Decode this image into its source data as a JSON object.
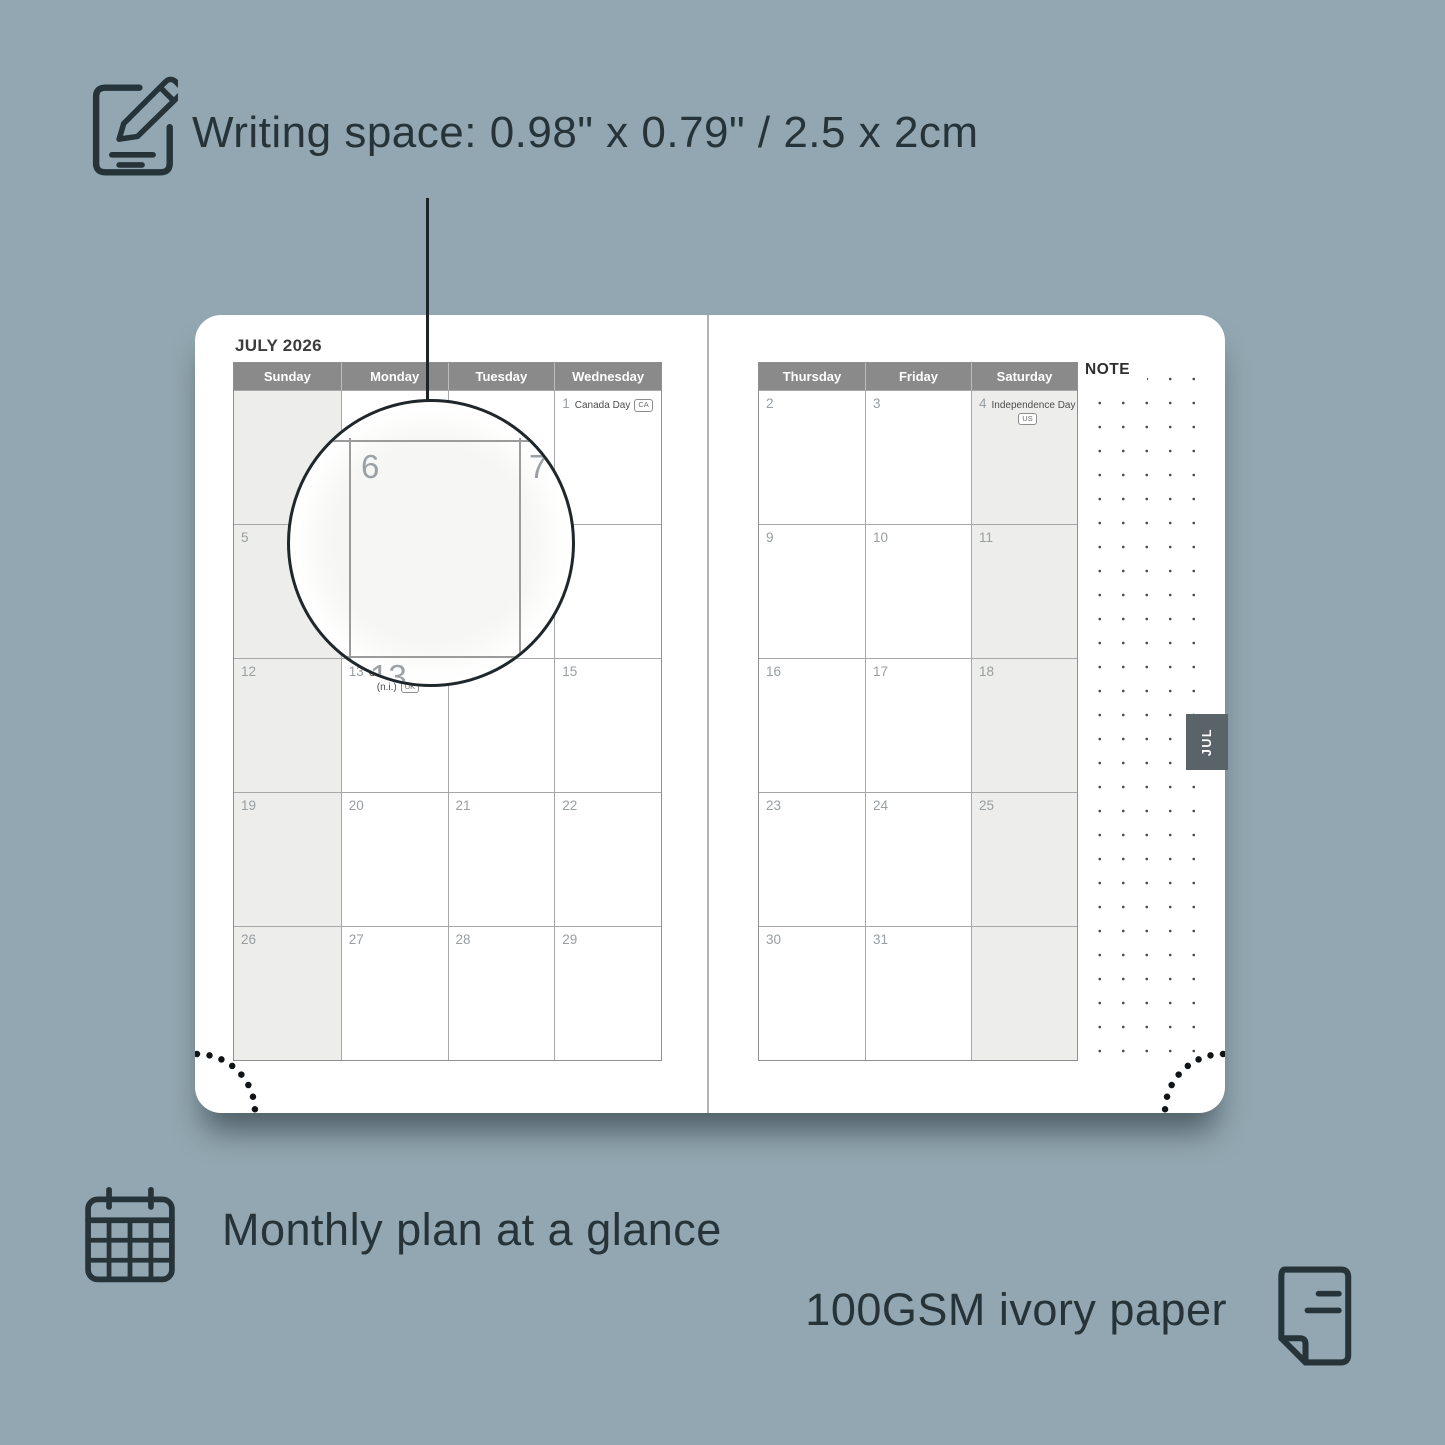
{
  "colors": {
    "background": "#92a7b1",
    "annotation_text": "#26343a",
    "header_bar": "#8a8a8a",
    "shaded_cell": "#ededeb",
    "tab": "#5a6468"
  },
  "features": {
    "writing_space": "Writing space: 0.98\" x 0.79\" / 2.5 x 2cm",
    "monthly_plan": "Monthly plan at a glance",
    "paper": "100GSM ivory paper"
  },
  "icons": {
    "top": "pencil-note-icon",
    "monthly": "calendar-grid-icon",
    "paper": "page-icon"
  },
  "planner": {
    "month_title": "JULY 2026",
    "note_label": "NOTE",
    "tab_label": "JUL",
    "left_headers": [
      "Sunday",
      "Monday",
      "Tuesday",
      "Wednesday"
    ],
    "right_headers": [
      "Thursday",
      "Friday",
      "Saturday"
    ],
    "left_rows": [
      [
        {
          "day": ""
        },
        {
          "day": ""
        },
        {
          "day": ""
        },
        {
          "day": "1",
          "holiday": "Canada Day",
          "badge": "CA"
        }
      ],
      [
        {
          "day": "5"
        },
        {
          "day": "6"
        },
        {
          "day": "7"
        },
        {
          "day": "8"
        }
      ],
      [
        {
          "day": "12"
        },
        {
          "day": "13",
          "holiday": "Orangemen's Day",
          "note": "(n.i.)",
          "badge": "UK"
        },
        {
          "day": "14"
        },
        {
          "day": "15"
        }
      ],
      [
        {
          "day": "19"
        },
        {
          "day": "20"
        },
        {
          "day": "21"
        },
        {
          "day": "22"
        }
      ],
      [
        {
          "day": "26"
        },
        {
          "day": "27"
        },
        {
          "day": "28"
        },
        {
          "day": "29"
        }
      ]
    ],
    "right_rows": [
      [
        {
          "day": "2"
        },
        {
          "day": "3"
        },
        {
          "day": "4",
          "holiday": "Independence Day",
          "badge": "US"
        }
      ],
      [
        {
          "day": "9"
        },
        {
          "day": "10"
        },
        {
          "day": "11"
        }
      ],
      [
        {
          "day": "16"
        },
        {
          "day": "17"
        },
        {
          "day": "18"
        }
      ],
      [
        {
          "day": "23"
        },
        {
          "day": "24"
        },
        {
          "day": "25"
        }
      ],
      [
        {
          "day": "30"
        },
        {
          "day": "31"
        },
        {
          "day": ""
        }
      ]
    ],
    "magnifier": {
      "day_main": "6",
      "day_next": "7",
      "day_below": "13"
    }
  }
}
